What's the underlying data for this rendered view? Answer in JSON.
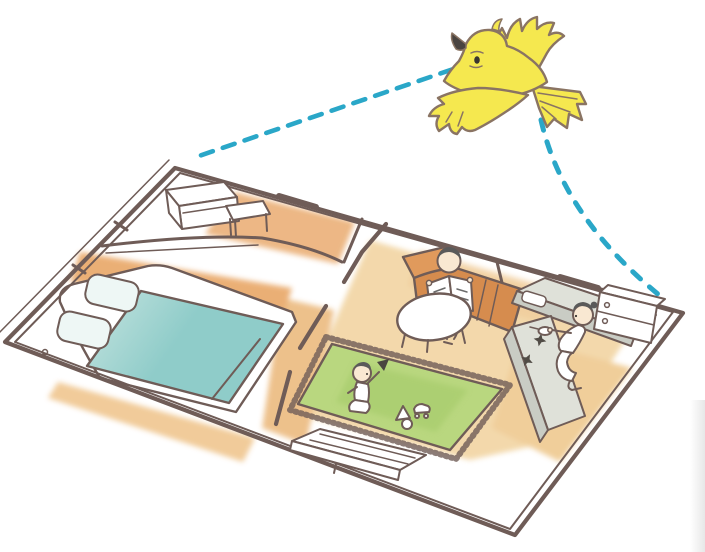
{
  "scene": {
    "description": "Hand-drawn watercolor illustration: a yellow bird flies at the top right and looks down along two dashed teal sight-lines at a cutaway floor plan of a home, drawn in bird's-eye perspective. The plan contains a small study with a white desk and stool, a bedroom with a double bed (teal blanket, two pillows), a living room with an orange L-shaped sofa where a parent sits reading a newspaper beside a white oval table, a green fringed rug where a child plays with blocks, a toy car and a ball, a kitchen with gray counters, two stove burners, a sink and a cooking parent, white cabinets along the wall, and a low white TV board by the bottom wall.",
    "elements": {
      "bird": "yellow bird in flight, seen from below",
      "sightlines": "dashed teal lines from the bird's eye to the two far corners of the floor plan",
      "study": "white desk and stool in the small upper-left room",
      "bedroom": "double bed with teal blanket and two pillows against the left wall",
      "living_room": "orange L-shaped sofa, parent reading a newspaper, white oval coffee table",
      "play_rug": "green fringed rug with kneeling child, triangle block, toy car and ball",
      "kitchen": "gray counter with sink, peninsula with two star-shaped burners, cooking parent, white cabinets with round knobs",
      "tv_console": "low white board against the bottom wall"
    }
  },
  "palette": {
    "white": "#ffffff",
    "wall": "#6f5c57",
    "birdOutline": "#8a7463",
    "birdYellow": "#f5e84f",
    "beakDark": "#4a4440",
    "dashTeal": "#2aa7c8",
    "floorTan": "#f2d5a4",
    "floorOrange": "#e9a96b",
    "floorOrangeSoft": "#f0c792",
    "hallTan": "#ecbc82",
    "kitchenTan": "#efca92",
    "rugGreen": "#b9d77f",
    "rugGreenDark": "#a3c968",
    "sofaOrange": "#e09a5c",
    "sofaOrangeDark": "#d68c4e",
    "bedTealLight": "#c6e4e0",
    "bedTealDark": "#8fccc9",
    "pillowTint": "#eef7f5",
    "counterGray": "#dfe1d9",
    "counterGrayDark": "#c9ccc4",
    "skin": "#f9e8d2",
    "hair": "#5a5a5a",
    "burner": "#514c46",
    "edgeShadow": "#e9e9e9"
  }
}
